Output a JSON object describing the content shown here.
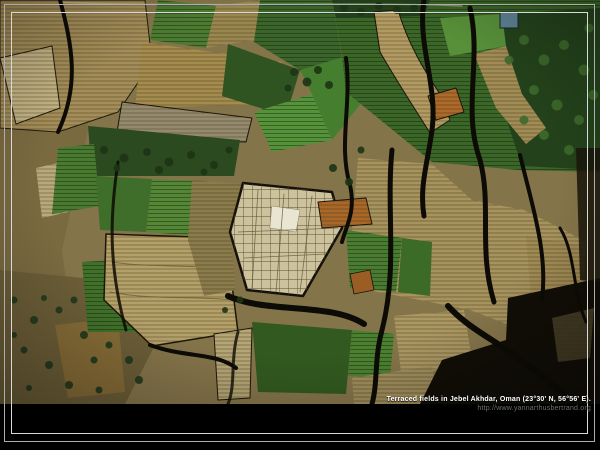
{
  "caption": {
    "title": "Terraced fields in Jebel Akhdar, Oman (23°30' N, 56°56' E).",
    "url": "http://www.yannarthusbertrand.org"
  },
  "photo": {
    "alt": "Aerial view of terraced agricultural fields: patchwork of green crop plots and tan striped terraces cut by dark winding ravines, tree clusters top-right and bottom-left",
    "width": 600,
    "height": 404
  },
  "frame": {
    "mat_color": "#000000",
    "outer_line_color": "#adadad",
    "inner_line_color": "#d9d9d9"
  },
  "palette": {
    "base_tan": "#84744a",
    "pale_plot": "#ccc29c",
    "bright_plot": "#e9e5d3",
    "green_mid": "#4a7a30",
    "green_dark": "#23421b",
    "orange_plot": "#ad6a2a",
    "ravine": "#0d0b05",
    "water_tank_blue": "#4f7580"
  },
  "scene": {
    "shapes": [
      {
        "t": "rect",
        "x": 0,
        "y": 0,
        "w": 600,
        "h": 404,
        "f": "#84744a"
      },
      {
        "t": "poly",
        "p": "0,0 78,0 88,130 62,250 72,330 45,404 0,404",
        "f": "#7a6a40"
      },
      {
        "t": "poly",
        "p": "0,270 125,282 155,345 125,404 0,404",
        "f": "#6b5d37"
      },
      {
        "t": "poly",
        "p": "55,325 118,318 125,392 68,398",
        "f": "#8a6d36",
        "o": 0.85
      },
      {
        "t": "poly",
        "p": "0,0 145,0 152,62 118,112 58,132 0,128",
        "f": "#a38d58",
        "pat": "rows-tan",
        "s": "#201a0e",
        "sw": 1
      },
      {
        "t": "poly",
        "p": "0,58 52,46 60,108 16,124",
        "f": "#c2b283",
        "pat": "rows-tan",
        "s": "#201a0e",
        "sw": 1
      },
      {
        "t": "poly",
        "p": "36,168 62,162 68,212 42,218",
        "f": "#bcac7e",
        "pat": "rows-tan",
        "o": 0.95
      },
      {
        "t": "poly",
        "p": "142,42 282,62 272,104 135,108",
        "f": "#a58c4e",
        "pat": "rows-tan"
      },
      {
        "t": "poly",
        "p": "122,102 252,118 246,142 116,138",
        "f": "#958a6d",
        "pat": "rows-tan",
        "s": "#1c160c",
        "sw": 1
      },
      {
        "t": "poly",
        "p": "158,0 216,6 206,48 150,40",
        "f": "#4d7a31",
        "pat": "rows-green"
      },
      {
        "t": "poly",
        "p": "216,6 260,0 254,40 206,48",
        "f": "#99874f",
        "pat": "rows-tan"
      },
      {
        "t": "poly",
        "p": "260,0 332,0 342,58 300,70 254,42",
        "f": "#3a642a",
        "pat": "rows-green"
      },
      {
        "t": "poly",
        "p": "228,44 300,70 286,116 222,96",
        "f": "#2f5422"
      },
      {
        "t": "poly",
        "p": "254,112 312,94 332,140 272,152",
        "f": "#55923a",
        "pat": "rows-green"
      },
      {
        "t": "poly",
        "p": "300,70 346,56 362,102 332,140 312,94",
        "f": "#457e2e"
      },
      {
        "t": "poly",
        "p": "332,0 600,0 600,172 518,170 432,162 346,92 342,56",
        "f": "#3b6628",
        "pat": "rows-green"
      },
      {
        "t": "poly",
        "p": "332,0 430,0 424,16 336,18",
        "f": "#22401a"
      },
      {
        "t": "poly",
        "p": "505,14 600,8 600,170 522,166 496,88",
        "f": "#23421b"
      },
      {
        "t": "path",
        "d": "M374,12 L398,10 C408,44 424,70 440,94 L450,120 L430,133 C413,106 396,80 380,52 Z",
        "f": "#b29b63",
        "pat": "rows-tan",
        "s": "#1a140a",
        "sw": 1
      },
      {
        "t": "poly",
        "p": "474,54 506,46 522,94 546,128 526,144 496,108",
        "f": "#a28c56",
        "pat": "rows-tan"
      },
      {
        "t": "poly",
        "p": "440,18 502,14 506,46 450,56",
        "f": "#579039"
      },
      {
        "t": "rect",
        "x": 500,
        "y": 12,
        "w": 18,
        "h": 16,
        "f": "#5d8191",
        "s": "#17262e",
        "sw": 1
      },
      {
        "t": "poly",
        "p": "428,96 456,88 464,112 436,120",
        "f": "#ad6a2a",
        "pat": "rows-tan",
        "s": "#1a140a",
        "sw": 1
      },
      {
        "t": "poly",
        "p": "88,126 240,140 234,176 92,176",
        "f": "#2b4a1f"
      },
      {
        "t": "poly",
        "p": "58,148 94,144 100,206 52,214",
        "f": "#4a7a30",
        "pat": "rows-green"
      },
      {
        "t": "poly",
        "p": "96,176 152,179 146,232 100,230",
        "f": "#3e6e29"
      },
      {
        "t": "poly",
        "p": "152,179 206,181 199,236 146,232",
        "f": "#548636",
        "pat": "rows-green"
      },
      {
        "t": "poly",
        "p": "82,262 146,258 142,332 88,332",
        "f": "#41702a",
        "pat": "rows-green"
      },
      {
        "t": "poly",
        "p": "106,234 226,238 238,332 152,346 104,300",
        "f": "#b4a069",
        "pat": "rows-tan",
        "s": "#1c160a",
        "sw": 1.5
      },
      {
        "t": "path",
        "d": "M112,262 C150,268 195,264 232,270 M110,292 C150,300 195,296 234,300",
        "f": "none",
        "s": "#6b5d38",
        "sw": 1,
        "o": 0.8
      },
      {
        "t": "poly",
        "p": "192,180 244,184 230,232 236,290 204,296 188,240",
        "f": "#8b7d4b",
        "pat": "rows-tan"
      },
      {
        "t": "poly",
        "p": "358,158 432,164 472,200 524,210 564,230 586,242 580,332 522,330 470,310 420,300 368,290 352,230",
        "f": "#a7935e",
        "pat": "rows-tan"
      },
      {
        "t": "poly",
        "p": "346,230 402,238 396,292 350,288",
        "f": "#497c30",
        "pat": "rows-green"
      },
      {
        "t": "poly",
        "p": "402,238 432,242 430,296 398,292",
        "f": "#3c6a27"
      },
      {
        "t": "poly",
        "p": "526,236 582,246 576,316 532,312",
        "f": "#a08a54",
        "pat": "rows-tan"
      },
      {
        "t": "poly",
        "p": "243,183 332,192 342,228 303,296 247,290 230,232",
        "f": "#ccc29c",
        "pat": "grid",
        "s": "#15110a",
        "sw": 2.5
      },
      {
        "t": "poly",
        "p": "272,206 300,210 296,232 270,228",
        "f": "#e9e5d3",
        "s": "#8a8268",
        "sw": 0.5
      },
      {
        "t": "path",
        "d": "M258,190 L252,288 M284,194 L276,292 M312,196 L300,292 M238,232 L338,228 M244,258 L326,254",
        "f": "none",
        "s": "#5f563b",
        "sw": 0.8,
        "o": 0.8
      },
      {
        "t": "poly",
        "p": "318,202 366,198 372,224 322,228",
        "f": "#aa6828",
        "pat": "rows-tan",
        "s": "#1a140a",
        "sw": 1
      },
      {
        "t": "poly",
        "p": "350,274 370,270 374,290 354,294",
        "f": "#9a5e25",
        "s": "#1a140a",
        "sw": 0.8
      },
      {
        "t": "poly",
        "p": "252,322 352,330 346,394 258,392",
        "f": "#32591f"
      },
      {
        "t": "poly",
        "p": "214,334 252,328 250,398 218,400",
        "f": "#b5a676",
        "pat": "rows-tan",
        "s": "#1c160a",
        "sw": 1
      },
      {
        "t": "poly",
        "p": "352,330 394,334 390,378 348,376",
        "f": "#4b8031",
        "pat": "rows-green"
      },
      {
        "t": "poly",
        "p": "394,316 464,310 472,360 402,380",
        "f": "#ab9762",
        "pat": "rows-tan"
      },
      {
        "t": "poly",
        "p": "352,378 432,366 438,404 354,404",
        "f": "#a08e5c",
        "pat": "rows-tan"
      },
      {
        "t": "poly",
        "p": "508,298 600,278 600,404 420,404 442,360 506,340",
        "f": "#110e07"
      },
      {
        "t": "poly",
        "p": "552,318 594,308 590,358 558,362",
        "f": "#564d2f",
        "pat": "rows-tan",
        "o": 0.7
      },
      {
        "t": "poly",
        "p": "576,148 600,148 600,282 580,280",
        "f": "#191509",
        "o": 0.85
      },
      {
        "t": "path",
        "d": "M60,2 C180,8 340,1 462,6",
        "f": "none",
        "s": "#cfc4a0",
        "sw": 1.4,
        "o": 0.55
      },
      {
        "t": "path",
        "d": "M60,0 C72,45 80,85 58,132",
        "f": "none",
        "s": "#0d0b05",
        "sw": 4
      },
      {
        "t": "path",
        "d": "M118,162 C110,215 108,265 126,330",
        "f": "none",
        "s": "#0d0b05",
        "sw": 3,
        "o": 0.85
      },
      {
        "t": "path",
        "d": "M150,345 C185,358 215,352 236,368",
        "f": "none",
        "s": "#0d0b05",
        "sw": 4
      },
      {
        "t": "path",
        "d": "M228,296 C268,314 330,302 364,324",
        "f": "none",
        "s": "#0d0b05",
        "sw": 6
      },
      {
        "t": "path",
        "d": "M346,58 C352,105 338,145 350,185 C356,212 346,226 342,242",
        "f": "none",
        "s": "#0d0b05",
        "sw": 4
      },
      {
        "t": "path",
        "d": "M424,0 C417,45 438,85 432,130 C428,162 419,186 424,216",
        "f": "none",
        "s": "#0d0b05",
        "sw": 5
      },
      {
        "t": "path",
        "d": "M470,8 C482,60 462,110 480,160 C492,205 478,250 494,302",
        "f": "none",
        "s": "#0d0b05",
        "sw": 5
      },
      {
        "t": "path",
        "d": "M392,150 C386,210 398,268 382,330 C374,360 378,382 372,404",
        "f": "none",
        "s": "#0d0b05",
        "sw": 5
      },
      {
        "t": "path",
        "d": "M520,155 C532,205 548,252 542,300",
        "f": "none",
        "s": "#0d0b05",
        "sw": 4
      },
      {
        "t": "path",
        "d": "M448,306 C470,330 496,340 520,360 C546,378 560,390 572,404",
        "f": "none",
        "s": "#0d0b05",
        "sw": 6
      },
      {
        "t": "path",
        "d": "M560,228 C576,254 572,290 586,322",
        "f": "none",
        "s": "#0d0b05",
        "sw": 3
      },
      {
        "t": "path",
        "d": "M238,332 C230,360 236,385 228,404",
        "f": "none",
        "s": "#0d0b05",
        "sw": 3,
        "o": 0.8
      }
    ],
    "dots": [
      {
        "f": "#1d3415",
        "pts": [
          [
            104,
            150,
            4
          ],
          [
            124,
            158,
            4.5
          ],
          [
            147,
            152,
            4
          ],
          [
            169,
            162,
            4.5
          ],
          [
            191,
            155,
            4
          ],
          [
            214,
            165,
            4
          ],
          [
            229,
            150,
            3.5
          ],
          [
            117,
            168,
            3.5
          ],
          [
            159,
            170,
            4
          ],
          [
            204,
            172,
            3.5
          ]
        ]
      },
      {
        "f": "#1d3415",
        "pts": [
          [
            294,
            72,
            4
          ],
          [
            307,
            82,
            4.5
          ],
          [
            318,
            70,
            4
          ],
          [
            288,
            88,
            3.5
          ],
          [
            329,
            85,
            4
          ]
        ]
      },
      {
        "f": "#20371b",
        "pts": [
          [
            14,
            300,
            3.5
          ],
          [
            34,
            320,
            4
          ],
          [
            59,
            310,
            3.5
          ],
          [
            84,
            335,
            4
          ],
          [
            24,
            350,
            3.5
          ],
          [
            49,
            365,
            4
          ],
          [
            94,
            360,
            3.5
          ],
          [
            69,
            385,
            4
          ],
          [
            29,
            388,
            3
          ],
          [
            109,
            345,
            3.5
          ],
          [
            129,
            360,
            4
          ],
          [
            14,
            335,
            3
          ],
          [
            99,
            390,
            3.5
          ],
          [
            139,
            380,
            4
          ],
          [
            44,
            298,
            3
          ],
          [
            74,
            300,
            3.5
          ]
        ]
      },
      {
        "f": "#3e692b",
        "pts": [
          [
            524,
            40,
            5
          ],
          [
            544,
            60,
            5.5
          ],
          [
            564,
            45,
            5
          ],
          [
            584,
            70,
            5.5
          ],
          [
            534,
            90,
            5
          ],
          [
            557,
            105,
            5.5
          ],
          [
            579,
            120,
            5
          ],
          [
            544,
            135,
            5
          ],
          [
            524,
            120,
            4.5
          ],
          [
            569,
            150,
            5
          ],
          [
            593,
            95,
            5
          ],
          [
            589,
            28,
            4.5
          ],
          [
            509,
            60,
            4.5
          ]
        ]
      },
      {
        "f": "#1c3416",
        "pts": [
          [
            344,
            8,
            4
          ],
          [
            361,
            12,
            4
          ],
          [
            379,
            6,
            4
          ],
          [
            397,
            10,
            4
          ],
          [
            414,
            8,
            4
          ]
        ]
      },
      {
        "f": "#1d3415",
        "pts": [
          [
            333,
            168,
            4
          ],
          [
            349,
            182,
            4
          ],
          [
            361,
            150,
            3.5
          ],
          [
            240,
            300,
            3.5
          ],
          [
            225,
            310,
            3
          ]
        ]
      }
    ]
  }
}
